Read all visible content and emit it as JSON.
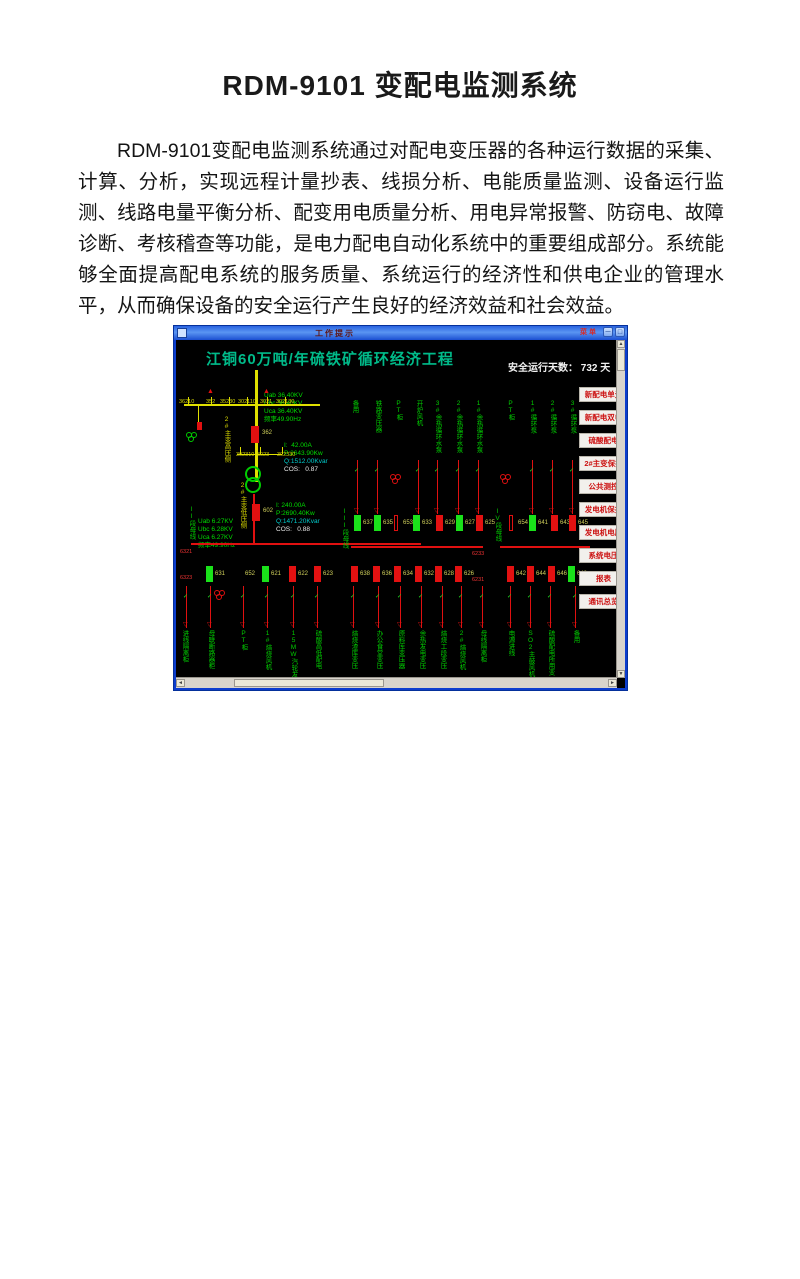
{
  "document": {
    "title": "RDM-9101 变配电监测系统",
    "body": "RDM-9101变配电监测系统通过对配电变压器的各种运行数据的采集、计算、分析，实现远程计量抄表、线损分析、电能质量监测、设备运行监测、线路电量平衡分析、配变用电质量分析、用电异常报警、防窃电、故障诊断、考核稽查等功能，是电力配电自动化系统中的重要组成部分。系统能够全面提高配电系统的服务质量、系统运行的经济性和供电企业的管理水平，从而确保设备的安全运行产生良好的经济效益和社会效益。"
  },
  "window": {
    "title": "工作提示",
    "menu_label": "菜单",
    "minimize_glyph": "－",
    "close_glyph": "□"
  },
  "scada": {
    "heading": "江铜60万吨/年硫铁矿循环经济工程",
    "safe_days": {
      "label": "安全运行天数：",
      "value": "732",
      "unit": "天"
    },
    "hv_bus_metrics": [
      "Uab 36.40KV",
      "Ubc 36.40KV",
      "Uca 36.40KV",
      "频率49.90Hz"
    ],
    "lv_bus_metrics": [
      "Uab 6.27KV",
      "Ubc 6.28KV",
      "Uca 6.27KV",
      "频率49.90Hz"
    ],
    "hv_power": [
      {
        "t": "I:  42.00A",
        "c": "#00dd00"
      },
      {
        "t": "P:2643.90Kw",
        "c": "#00dd00"
      },
      {
        "t": "Q:1512.00Kvar",
        "c": "#00cccc"
      },
      {
        "t": "COS:   0.87",
        "c": "#e8e8e8"
      }
    ],
    "lv_power": [
      {
        "t": "I: 240.00A",
        "c": "#00dd00"
      },
      {
        "t": "P:2690.40Kw",
        "c": "#00dd00"
      },
      {
        "t": "Q:1471.20Kvar",
        "c": "#00cccc"
      },
      {
        "t": "COS:   0.88",
        "c": "#e8e8e8"
      }
    ],
    "switch_labels": [
      {
        "t": "36210",
        "x": 1,
        "y": 57
      },
      {
        "t": "352",
        "x": 28,
        "y": 57
      },
      {
        "t": "35230",
        "x": 42,
        "y": 57
      },
      {
        "t": "302110",
        "x": 60,
        "y": 57
      },
      {
        "t": "3021",
        "x": 82,
        "y": 57
      },
      {
        "t": "302130",
        "x": 98,
        "y": 57
      },
      {
        "t": "302310",
        "x": 58,
        "y": 110
      },
      {
        "t": "3023",
        "x": 79,
        "y": 110
      },
      {
        "t": "302330",
        "x": 99,
        "y": 110
      }
    ],
    "equip_labels": [
      {
        "t": "362",
        "x": 84,
        "y": 88
      },
      {
        "t": "602",
        "x": 85,
        "y": 166
      }
    ],
    "bus_labels": [
      {
        "t": "6321",
        "x": 2,
        "y": 207
      },
      {
        "t": "6323",
        "x": 2,
        "y": 233
      },
      {
        "t": "6233",
        "x": 294,
        "y": 209
      },
      {
        "t": "6231",
        "x": 294,
        "y": 235
      }
    ],
    "vertical_yellow": [
      {
        "t": "2#主变高压侧",
        "x": 44,
        "y": 74
      },
      {
        "t": "2#主变低压侧",
        "x": 60,
        "y": 140
      }
    ],
    "vertical_green": [
      {
        "t": "II段母线",
        "x": 9,
        "y": 164
      },
      {
        "t": "III段母线",
        "x": 162,
        "y": 166
      },
      {
        "t": "IV段母线",
        "x": 315,
        "y": 166
      }
    ],
    "top_columns": [
      {
        "t": "备用",
        "x": 172
      },
      {
        "t": "铁路变压器",
        "x": 195
      },
      {
        "t": "PT柜",
        "x": 216
      },
      {
        "t": "开炉风机",
        "x": 236
      },
      {
        "t": "3#余热循环水泵",
        "x": 255
      },
      {
        "t": "2#余热循环水泵",
        "x": 276
      },
      {
        "t": "1#余热循环水泵",
        "x": 296
      },
      {
        "t": "PT柜",
        "x": 328
      },
      {
        "t": "1#循环泵",
        "x": 350
      },
      {
        "t": "2#循环泵",
        "x": 370
      },
      {
        "t": "3#循环泵",
        "x": 390
      }
    ],
    "bottom_columns": [
      {
        "t": "进线隔离柜",
        "x": 2
      },
      {
        "t": "母联断路器柜",
        "x": 28
      },
      {
        "t": "PT柜",
        "x": 61
      },
      {
        "t": "1#焙烧风机",
        "x": 85
      },
      {
        "t": "15MW汽轮发电",
        "x": 111
      },
      {
        "t": "硫酸高低配电",
        "x": 135
      },
      {
        "t": "焙烧渣库变压",
        "x": 171
      },
      {
        "t": "办公食堂变压",
        "x": 196
      },
      {
        "t": "原料库变压器",
        "x": 218
      },
      {
        "t": "余热发电变压",
        "x": 239
      },
      {
        "t": "焙烧工段变压",
        "x": 260
      },
      {
        "t": "2#焙烧风机",
        "x": 279
      },
      {
        "t": "母线隔离柜",
        "x": 300
      },
      {
        "t": "电源进线",
        "x": 328
      },
      {
        "t": "SO2主鼓风机",
        "x": 348
      },
      {
        "t": "硫酸配电所用变",
        "x": 368
      },
      {
        "t": "备用",
        "x": 393
      }
    ],
    "upper_devices": [
      {
        "t": "637",
        "x": 176,
        "c": "#1ae11a"
      },
      {
        "t": "635",
        "x": 196,
        "c": "#1ae11a"
      },
      {
        "t": "653",
        "x": 216,
        "cls": "hollow"
      },
      {
        "t": "633",
        "x": 235,
        "c": "#1ae11a"
      },
      {
        "t": "629",
        "x": 258,
        "c": "#e31111"
      },
      {
        "t": "627",
        "x": 278,
        "c": "#1ae11a"
      },
      {
        "t": "625",
        "x": 298,
        "c": "#e31111"
      },
      {
        "t": "654",
        "x": 331,
        "cls": "hollow"
      },
      {
        "t": "641",
        "x": 351,
        "c": "#1ae11a"
      },
      {
        "t": "643",
        "x": 373,
        "c": "#e31111"
      },
      {
        "t": "645",
        "x": 391,
        "c": "#e31111"
      }
    ],
    "lower_devices": [
      {
        "t": "631",
        "x": 28,
        "c": "#1ae11a"
      },
      {
        "t": "652",
        "x": 58,
        "cls": "nobox"
      },
      {
        "t": "621",
        "x": 84,
        "c": "#1ae11a"
      },
      {
        "t": "622",
        "x": 111,
        "c": "#e31111"
      },
      {
        "t": "623",
        "x": 136,
        "c": "#e31111"
      },
      {
        "t": "638",
        "x": 173,
        "c": "#e31111"
      },
      {
        "t": "636",
        "x": 195,
        "c": "#e31111"
      },
      {
        "t": "634",
        "x": 216,
        "c": "#e31111"
      },
      {
        "t": "632",
        "x": 237,
        "c": "#e31111"
      },
      {
        "t": "628",
        "x": 257,
        "c": "#e31111"
      },
      {
        "t": "626",
        "x": 277,
        "c": "#e31111"
      },
      {
        "t": "642",
        "x": 329,
        "c": "#e31111"
      },
      {
        "t": "644",
        "x": 349,
        "c": "#e31111"
      },
      {
        "t": "646",
        "x": 370,
        "c": "#e31111"
      },
      {
        "t": "648",
        "x": 390,
        "c": "#1ae11a"
      }
    ],
    "feeders_top": [
      {
        "x": 179
      },
      {
        "x": 199
      },
      {
        "x": 240
      },
      {
        "x": 259
      },
      {
        "x": 280
      },
      {
        "x": 300
      },
      {
        "x": 354
      },
      {
        "x": 374
      },
      {
        "x": 394
      }
    ],
    "feeders_bottom": [
      {
        "x": 8
      },
      {
        "x": 32
      },
      {
        "x": 65
      },
      {
        "x": 89
      },
      {
        "x": 115
      },
      {
        "x": 139
      },
      {
        "x": 175
      },
      {
        "x": 200
      },
      {
        "x": 222
      },
      {
        "x": 243
      },
      {
        "x": 264
      },
      {
        "x": 283
      },
      {
        "x": 304
      },
      {
        "x": 332
      },
      {
        "x": 352
      },
      {
        "x": 372
      },
      {
        "x": 397
      }
    ],
    "pt_symbols": [
      {
        "x": 212,
        "y": 132,
        "c": "#e01010"
      },
      {
        "x": 322,
        "y": 132,
        "c": "#e01010"
      },
      {
        "x": 8,
        "y": 90,
        "c": "#00cc00"
      },
      {
        "x": 36,
        "y": 248,
        "c": "#e01010"
      }
    ],
    "glyphs": [
      {
        "t": "▲",
        "x": 29,
        "y": 46,
        "c": "#e01010"
      },
      {
        "t": "▲",
        "x": 85,
        "y": 46,
        "c": "#e01010"
      }
    ],
    "lines": [
      {
        "x": 6,
        "y": 62,
        "w": 136,
        "h": 2,
        "c": "#e0e000"
      },
      {
        "x": 77,
        "y": 28,
        "w": 3,
        "h": 112,
        "c": "#e0e000"
      },
      {
        "x": 20,
        "y": 64,
        "w": 1,
        "h": 24,
        "c": "#e0e000"
      },
      {
        "x": 59,
        "y": 112,
        "w": 45,
        "h": 1,
        "c": "#e0e000"
      },
      {
        "x": 10,
        "y": 55,
        "w": 1,
        "h": 7,
        "c": "#e0e000"
      },
      {
        "x": 33,
        "y": 55,
        "w": 1,
        "h": 7,
        "c": "#e0e000"
      },
      {
        "x": 51,
        "y": 55,
        "w": 1,
        "h": 7,
        "c": "#e0e000"
      },
      {
        "x": 69,
        "y": 55,
        "w": 1,
        "h": 7,
        "c": "#e0e000"
      },
      {
        "x": 89,
        "y": 55,
        "w": 1,
        "h": 7,
        "c": "#e0e000"
      },
      {
        "x": 107,
        "y": 55,
        "w": 1,
        "h": 7,
        "c": "#e0e000"
      },
      {
        "x": 62,
        "y": 105,
        "w": 1,
        "h": 7,
        "c": "#e0e000"
      },
      {
        "x": 82,
        "y": 105,
        "w": 1,
        "h": 7,
        "c": "#e0e000"
      },
      {
        "x": 104,
        "y": 105,
        "w": 1,
        "h": 7,
        "c": "#e0e000"
      },
      {
        "x": 13,
        "y": 201,
        "w": 230,
        "h": 2,
        "c": "#e01010"
      },
      {
        "x": 173,
        "y": 204,
        "w": 132,
        "h": 2,
        "c": "#e01010"
      },
      {
        "x": 322,
        "y": 204,
        "w": 90,
        "h": 2,
        "c": "#e01010"
      },
      {
        "x": 75,
        "y": 152,
        "w": 2,
        "h": 50,
        "c": "#e01010"
      },
      {
        "x": 19,
        "y": 80,
        "w": 5,
        "h": 8,
        "c": "#e01010"
      },
      {
        "x": 73,
        "y": 84,
        "w": 8,
        "h": 17,
        "c": "#e01010"
      },
      {
        "x": 74,
        "y": 162,
        "w": 8,
        "h": 17,
        "c": "#e01010"
      }
    ],
    "buttons": [
      {
        "t": "新配电单元",
        "y": 45
      },
      {
        "t": "新配电双电",
        "y": 68
      },
      {
        "t": "硫酸配电",
        "y": 91
      },
      {
        "t": "2#主变保护",
        "y": 114
      },
      {
        "t": "公共测控",
        "y": 137
      },
      {
        "t": "发电机保护",
        "y": 160
      },
      {
        "t": "发电机电压",
        "y": 183
      },
      {
        "t": "系统电压",
        "y": 206
      },
      {
        "t": "报表",
        "y": 229
      },
      {
        "t": "通讯总览",
        "y": 252
      }
    ]
  }
}
